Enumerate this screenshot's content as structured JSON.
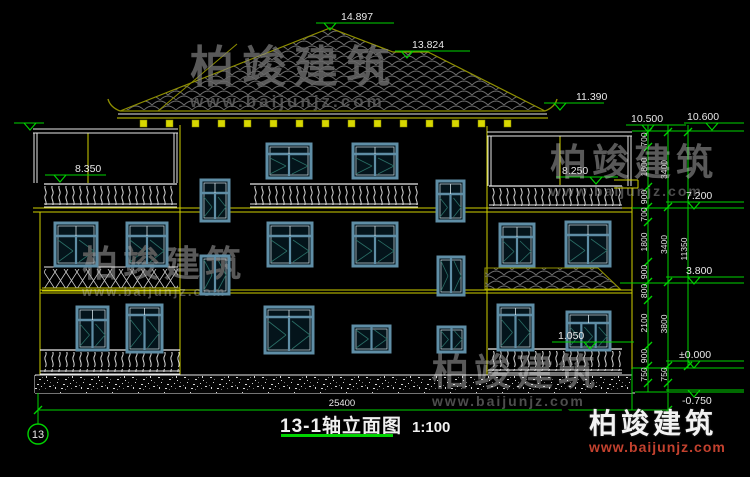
{
  "title_block": {
    "title": "13-1轴立面图",
    "scale": "1:100"
  },
  "watermarks": {
    "brand": "柏竣建筑",
    "url": "www.baijunjz.com"
  },
  "logo": {
    "brand": "柏竣建筑",
    "url": "www.baijunjz.com"
  },
  "colors": {
    "green": "#00d300",
    "white": "#e8e8e8",
    "yellow": "#cfcf00",
    "olive": "#8f8f00",
    "bracket": "#d8d800",
    "tile": "#6e6e6e",
    "win_frame": "#5f8ea6",
    "win_fill": "#04141b",
    "win_line": "#d3e2e9",
    "win_diag": "#2a6e66"
  },
  "drawing": {
    "axis_bubble": {
      "label": "13",
      "cx": 38,
      "cy": 434,
      "r": 10
    },
    "bottom_dim": {
      "label": "25400",
      "y": 410,
      "x1": 38,
      "x2": 668,
      "tx": 342,
      "ty": 406
    },
    "elevation_markers": [
      {
        "t": "14.897",
        "tx": 341,
        "ty": 20,
        "lx1": 316,
        "lx2": 394,
        "ly": 23,
        "ax": 330
      },
      {
        "t": "13.824",
        "tx": 412,
        "ty": 48,
        "lx1": 395,
        "lx2": 470,
        "ly": 51,
        "ax": 407
      },
      {
        "t": "11.390",
        "tx": 576,
        "ty": 100,
        "lx1": 544,
        "lx2": 604,
        "ly": 103,
        "ax": 560
      },
      {
        "t": "10.500",
        "tx": 631,
        "ty": 122,
        "lx1": 626,
        "lx2": 686,
        "ly": 125,
        "ax": 648
      },
      {
        "t": "10.600",
        "tx": 687,
        "ty": 120,
        "lx1": 684,
        "lx2": 744,
        "ly": 123,
        "ax": 712
      },
      {
        "t": "8.350",
        "tx": 75,
        "ty": 172,
        "lx1": 45,
        "lx2": 106,
        "ly": 175,
        "ax": 60
      },
      {
        "t": "8.250",
        "tx": 562,
        "ty": 174,
        "lx1": 556,
        "lx2": 618,
        "ly": 177,
        "ax": 596
      },
      {
        "t": "7.200",
        "tx": 686,
        "ty": 200,
        "lx1": 666,
        "lx2": 744,
        "ly": 202,
        "ax": 694
      },
      {
        "t": "3.800",
        "tx": 686,
        "ty": 274,
        "lx1": 666,
        "lx2": 744,
        "ly": 277,
        "ax": 694
      },
      {
        "t": "1.050",
        "tx": 558,
        "ty": 339,
        "lx1": 552,
        "lx2": 634,
        "ly": 342,
        "ax": 590
      },
      {
        "t": "±0.000",
        "tx": 679,
        "ty": 358,
        "lx1": 666,
        "lx2": 744,
        "ly": 361,
        "ax": 694
      },
      {
        "t": "-0.750",
        "tx": 682,
        "ty": 404,
        "lx1": 666,
        "lx2": 744,
        "ly": 390,
        "ax": 694,
        "tb": 1
      },
      {
        "t": "",
        "tx": 0,
        "ty": 0,
        "lx1": 14,
        "lx2": 44,
        "ly": 123,
        "ax": 30
      }
    ],
    "dim_chains": [
      {
        "x": 648,
        "top": 125,
        "bot": 392,
        "ticks": [
          132,
          147,
          187,
          207,
          222,
          262,
          282,
          300,
          346,
          366,
          383
        ],
        "labels": [
          "700",
          "1800",
          "900",
          "700",
          "1800",
          "900",
          "800",
          "2100",
          "900",
          "750"
        ]
      },
      {
        "x": 668,
        "top": 125,
        "bot": 392,
        "ticks": [
          132,
          207,
          282,
          366,
          383
        ],
        "labels": [
          "3400",
          "3400",
          "3800",
          "750"
        ]
      },
      {
        "x": 688,
        "top": 125,
        "bot": 368,
        "ticks": [
          132,
          366
        ],
        "labels": [
          "11350"
        ]
      }
    ],
    "ext_lines": [
      [
        632,
        131,
        744
      ],
      [
        632,
        208,
        744
      ],
      [
        620,
        283,
        744
      ],
      [
        632,
        368,
        744
      ],
      [
        635,
        392,
        744
      ]
    ],
    "aux_green": [
      [
        632,
        369,
        632,
        410
      ],
      [
        38,
        393,
        38,
        424
      ],
      [
        668,
        393,
        668,
        413
      ]
    ],
    "lines": [
      [
        "y",
        180,
        125,
        180,
        375
      ],
      [
        "y",
        487,
        126,
        487,
        375
      ],
      [
        "y",
        632,
        188,
        632,
        375
      ],
      [
        "y",
        40,
        212,
        40,
        375
      ],
      [
        "y",
        33,
        208,
        632,
        208
      ],
      [
        "y",
        33,
        212,
        632,
        212
      ],
      [
        "y",
        40,
        290,
        632,
        290
      ],
      [
        "y",
        40,
        293,
        632,
        293
      ],
      [
        "w",
        35,
        375,
        632,
        375
      ],
      [
        "w",
        35,
        393,
        635,
        393
      ],
      [
        "w",
        35,
        375,
        35,
        393
      ],
      [
        "w",
        632,
        375,
        632,
        393
      ],
      [
        "y",
        88,
        133,
        88,
        183
      ],
      [
        "y",
        560,
        136,
        560,
        185
      ],
      [
        "w",
        33,
        129,
        178,
        129
      ],
      [
        "w",
        33,
        133,
        178,
        133
      ],
      [
        "w",
        34,
        133,
        34,
        183
      ],
      [
        "w",
        37,
        133,
        37,
        183
      ],
      [
        "w",
        174,
        133,
        174,
        183
      ],
      [
        "w",
        177,
        133,
        177,
        183
      ],
      [
        "w",
        487,
        132,
        632,
        132
      ],
      [
        "w",
        487,
        136,
        632,
        136
      ],
      [
        "w",
        488,
        136,
        488,
        186
      ],
      [
        "w",
        491,
        136,
        491,
        186
      ],
      [
        "w",
        628,
        136,
        628,
        186
      ],
      [
        "w",
        631,
        136,
        631,
        186
      ],
      [
        "w",
        120,
        111,
        545,
        111
      ],
      [
        "w",
        118,
        114,
        547,
        114
      ],
      [
        "y",
        117,
        118,
        548,
        118
      ],
      [
        "y",
        614,
        180,
        638,
        180
      ],
      [
        "y",
        614,
        188,
        638,
        188
      ],
      [
        "y",
        638,
        180,
        638,
        188
      ],
      [
        "w",
        44,
        267,
        178,
        267
      ],
      [
        "y",
        42,
        288,
        180,
        288
      ],
      [
        "y",
        42,
        291,
        180,
        291
      ]
    ],
    "roof": {
      "outline": [
        [
          120,
          111
        ],
        [
          330,
          28
        ],
        [
          393,
          52
        ],
        [
          428,
          52
        ],
        [
          545,
          111
        ]
      ],
      "hip": [
        237,
        44,
        158,
        111
      ],
      "tips": [
        "M120 111 Q110 107 108 99",
        "M545 111 Q555 107 557 99"
      ],
      "pent": [
        [
          485,
          268
        ],
        [
          598,
          268
        ],
        [
          620,
          289
        ],
        [
          485,
          289
        ]
      ]
    },
    "brackets": {
      "x0": 140,
      "step": 26,
      "count": 15,
      "y": 120,
      "w": 7,
      "h": 7
    },
    "foundation": {
      "x": 35,
      "y": 376,
      "w": 597,
      "h": 17
    },
    "railings": [
      {
        "x": 44,
        "y": 184,
        "w": 133,
        "h": 23
      },
      {
        "x": 250,
        "y": 184,
        "w": 168,
        "h": 23
      },
      {
        "x": 489,
        "y": 186,
        "w": 133,
        "h": 22
      },
      {
        "x": 40,
        "y": 350,
        "w": 140,
        "h": 24
      },
      {
        "x": 488,
        "y": 349,
        "w": 134,
        "h": 24
      }
    ],
    "lattice": {
      "x": 44,
      "y": 269,
      "w": 134,
      "h": 19
    },
    "windows": [
      [
        267,
        144,
        44,
        34,
        "t2"
      ],
      [
        353,
        144,
        44,
        34,
        "t2"
      ],
      [
        201,
        180,
        28,
        41,
        "st"
      ],
      [
        437,
        181,
        27,
        40,
        "st"
      ],
      [
        55,
        223,
        42,
        43,
        "t2"
      ],
      [
        127,
        223,
        40,
        43,
        "t2"
      ],
      [
        268,
        223,
        44,
        43,
        "t2"
      ],
      [
        353,
        223,
        44,
        43,
        "t2"
      ],
      [
        201,
        256,
        28,
        38,
        "s"
      ],
      [
        438,
        257,
        26,
        38,
        "s"
      ],
      [
        500,
        224,
        34,
        42,
        "t2"
      ],
      [
        566,
        222,
        44,
        44,
        "t2"
      ],
      [
        77,
        307,
        31,
        43,
        "t2"
      ],
      [
        127,
        305,
        35,
        47,
        "d"
      ],
      [
        265,
        307,
        48,
        46,
        "d"
      ],
      [
        353,
        326,
        37,
        26,
        "s"
      ],
      [
        438,
        327,
        27,
        25,
        "s"
      ],
      [
        498,
        305,
        35,
        45,
        "d"
      ],
      [
        567,
        312,
        43,
        38,
        "t3"
      ]
    ]
  }
}
